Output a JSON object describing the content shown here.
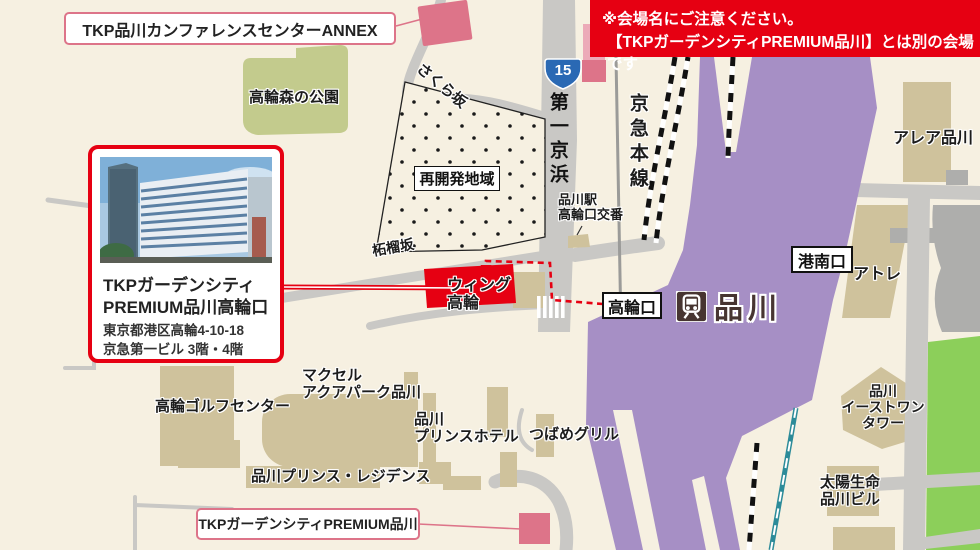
{
  "banner": {
    "line1": "※会場名にご注意ください。",
    "line2": "【TKPガーデンシティPREMIUM品川】とは別の会場です"
  },
  "callout_top": {
    "label": "TKP品川カンファレンスセンターANNEX"
  },
  "callout_bottom": {
    "label": "TKPガーデンシティPREMIUM品川"
  },
  "venue_card": {
    "title_line1": "TKPガーデンシティ",
    "title_line2": "PREMIUM品川高輪口",
    "address_line1": "東京都港区高輪4-10-18",
    "address_line2": "京急第一ビル 3階・4階"
  },
  "route_badge": {
    "number": "15"
  },
  "labels": {
    "park": "高輪森の公園",
    "sakura_slope": "さくら坂",
    "redevelopment": "再開発地域",
    "daiichi_keihin": "第一京浜",
    "keikyu_main_line": "京急本線",
    "koban_line1": "品川駅",
    "koban_line2": "高輪口交番",
    "alea_shinagawa": "アレア品川",
    "konan_exit": "港南口",
    "atre": "アトレ",
    "takanawa_exit": "高輪口",
    "station_name": "品川",
    "wing_line1": "ウィング",
    "wing_line2": "高輪",
    "zakuro_slope": "柘榴坂",
    "golf_center": "高輪ゴルフセンター",
    "maxell_line1": "マクセル",
    "maxell_line2": "アクアパーク品川",
    "prince_hotel_line1": "品川",
    "prince_hotel_line2": "プリンスホテル",
    "tsubame_grill": "つばめグリル",
    "prince_residence": "品川プリンス・レジデンス",
    "east_one_line1": "品川",
    "east_one_line2": "イーストワン",
    "east_one_line3": "タワー",
    "taiyo_line1": "太陽生命",
    "taiyo_line2": "品川ビル"
  },
  "colors": {
    "background": "#f6f0e1",
    "road_gray": "#c9c8c5",
    "building_tan": "#cfc29c",
    "park_olive": "#c3cb8d",
    "grass_green": "#8ccf5a",
    "station_purple": "#a68fc5",
    "rail_teal": "#2c8b99",
    "accent_red": "#e60012",
    "pink_building": "#dd7489",
    "route_badge_blue": "#2a69b4",
    "station_text_brown": "#473531"
  }
}
